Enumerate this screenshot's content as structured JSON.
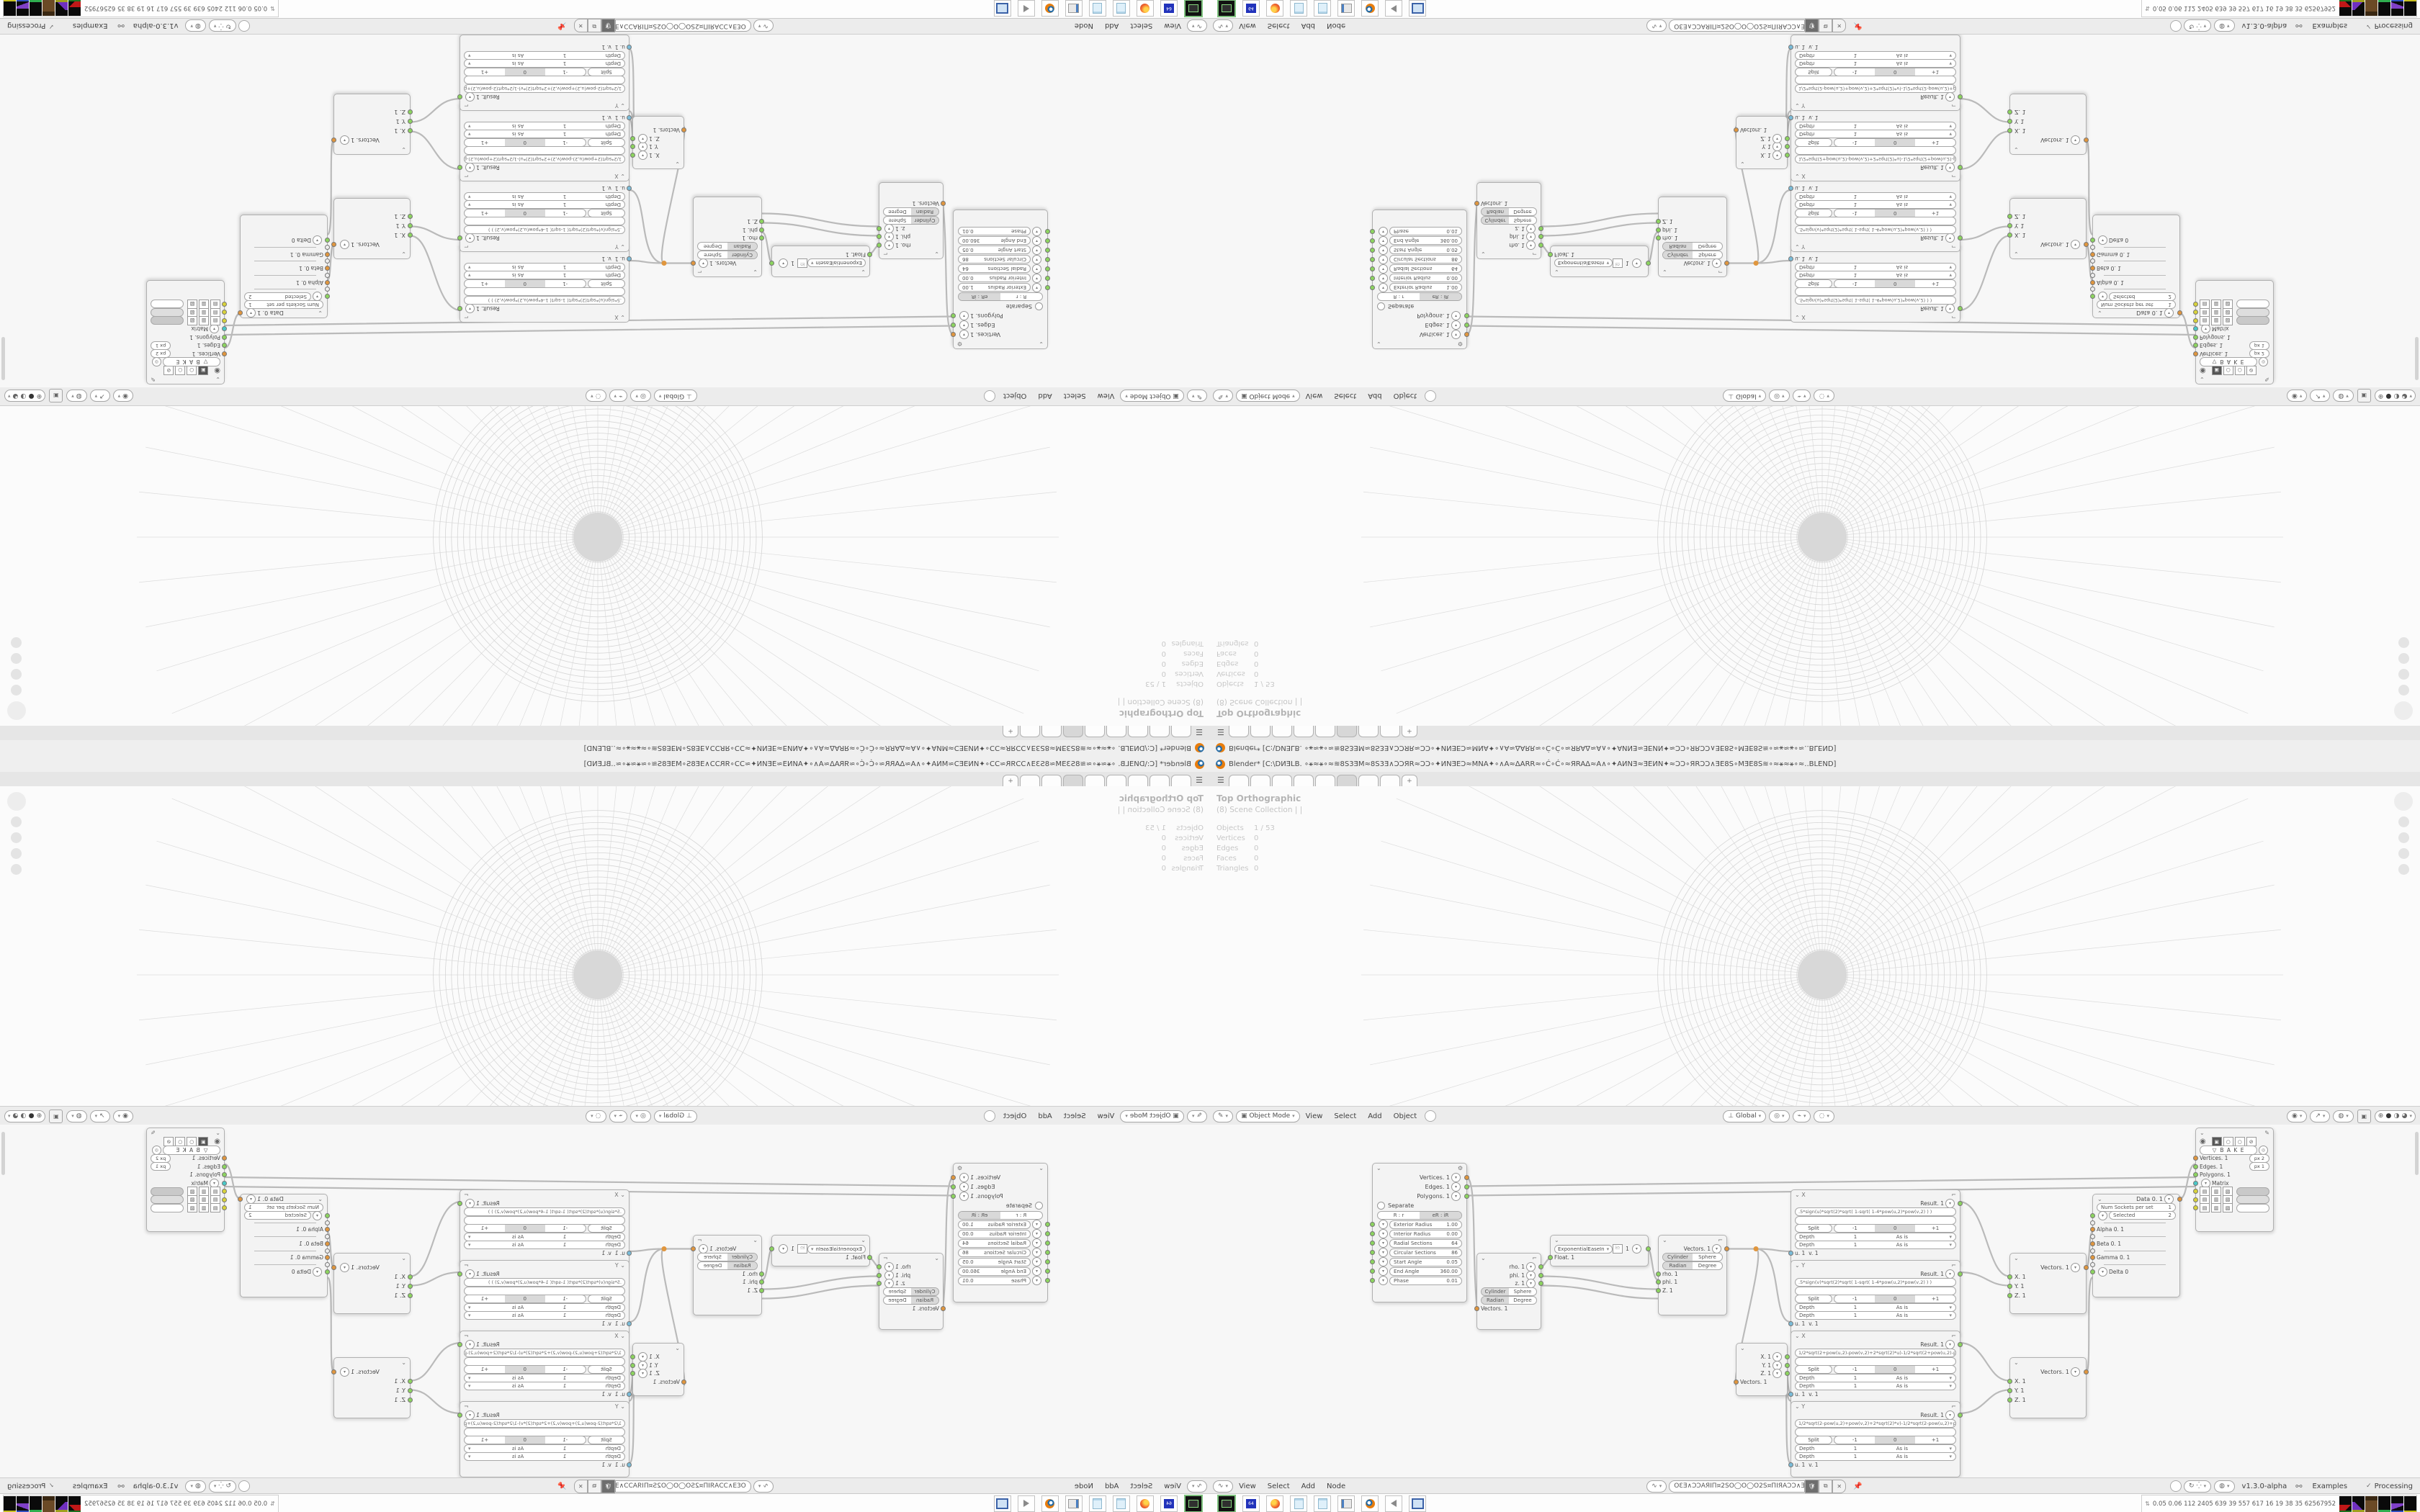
{
  "window": {
    "title": "Blender* [C:\\DИƎLB. ∘⚹≈⚹∘≈≋8S3ƎM≈8S3Ǝ∧ƆƆЯR≈ƆƆ∘✦ИNƎEƆ≈MNA✦∘∧A≈ΔARR≈∘Ć∘Ć∘≈ЯRAΔ≈A∧∘✦AИNƎ≈ƎEИN✦≈ƆƆ∘ЯRƆƆ∧ƎE8S∘MƎE8S≋∘≈⚹≈⚹∘≈..BLEND]",
    "tab_add": "+"
  },
  "viewport": {
    "view_label": "Top Orthographic",
    "collection_label": "(8) Scene Collection | |",
    "stats": [
      {
        "label": "Objects",
        "value": "1 / 53"
      },
      {
        "label": "Vertices",
        "value": "0"
      },
      {
        "label": "Edges",
        "value": "0"
      },
      {
        "label": "Faces",
        "value": "0"
      },
      {
        "label": "Triangles",
        "value": "0"
      }
    ],
    "header": {
      "mode": "Object Mode",
      "menu_view": "View",
      "menu_select": "Select",
      "menu_add": "Add",
      "menu_object": "Object",
      "orientation": "Global"
    }
  },
  "node_editor": {
    "header": {
      "menu_view": "View",
      "menu_select": "Select",
      "menu_add": "Add",
      "menu_node": "Node",
      "tree_name": "OƐƎ∧ƆƆAЯIΠ¤2SO◯O◯O2S¤ΠIЯAƆƆ∧ƎƐO",
      "version": "v1.3.0-alpha",
      "examples_label": "Examples",
      "processing_label": "Processing"
    }
  },
  "nodes": {
    "torus": {
      "out_vertices": "Vertices. 1",
      "out_edges": "Edges. 1",
      "out_polygons": "Polygons. 1",
      "separate_label": "Separate",
      "mode_a": "R : r",
      "mode_b": "eR : iR",
      "params": [
        {
          "label": "Exterior Radius",
          "value": "1.00"
        },
        {
          "label": "Interior Radius",
          "value": "0.00"
        },
        {
          "label": "Radial Sections",
          "value": "64"
        },
        {
          "label": "Circular Sections",
          "value": "86"
        },
        {
          "label": "Start Angle",
          "value": "0.05"
        },
        {
          "label": "End Angle",
          "value": "360.00"
        },
        {
          "label": "Phase",
          "value": "0.01"
        }
      ]
    },
    "vector_polar_out": {
      "out_rho": "rho. 1",
      "out_phi": "phi. 1",
      "out_z": "z. 1",
      "toggle_cylinder": "Cylinder",
      "toggle_sphere": "Sphere",
      "toggle_radian": "Radian",
      "toggle_degree": "Degree",
      "in_vectors": "Vectors. 1"
    },
    "easing": {
      "mode": "ExponentialEaseIn",
      "value": "1",
      "in_float": "Float. 1"
    },
    "vector_polar_in": {
      "out_vectors": "Vectors. 1",
      "toggle_cylinder": "Cylinder",
      "toggle_sphere": "Sphere",
      "toggle_radian": "Radian",
      "toggle_degree": "Degree",
      "in_rho": "rho. 1",
      "in_phi": "phi. 1",
      "in_z": "Z. 1"
    },
    "vector_out": {
      "out_x": "X. 1",
      "out_y": "Y. 1",
      "out_z": "Z. 1",
      "in_vectors": "Vectors. 1"
    },
    "formula_common": {
      "result": "Result. 1",
      "split": "Split",
      "minus": "-1",
      "zero": "0",
      "plus": "+1",
      "depth_label": "Depth",
      "depth_value": "1",
      "wrap": "As is",
      "in_u": "u. 1",
      "in_v": "v. 1"
    },
    "formulas": [
      {
        "label": "X",
        "formula": ".5*sign(u)*sqrt(2)*sqrt( 1-sqrt( 1-4*pow(u,2)*pow(v,2) ) )"
      },
      {
        "label": "Y",
        "formula": ".5*sign(v)*sqrt(2)*sqrt( 1-sqrt( 1-4*pow(u,2)*pow(v,2) ) )"
      },
      {
        "label": "X",
        "formula": "1/2*sqrt(2+pow(u,2)-pow(v,2)+2*sqrt(2)*u)-1/2*sqrt(2+pow(u,2)-pow(v,2)-2*sqrt(2)*u)"
      },
      {
        "label": "Y",
        "formula": "1/2*sqrt(2-pow(u,2)+pow(v,2)+2*sqrt(2)*v)-1/2*sqrt(2-pow(u,2)+pow(v,2)-2*sqrt(2)*v)"
      }
    ],
    "vector_in": {
      "out_vectors": "Vectors. 1",
      "in_x": "X. 1",
      "in_y": "Y. 1",
      "in_z": "Z. 1"
    },
    "input_switch": {
      "out_data": "Data 0. 1",
      "num_sockets_label": "Num Sockets per set",
      "num_sockets_value": "1",
      "selected_label": "Selected",
      "selected_value": "2",
      "in_alpha": "Alpha 0. 1",
      "in_beta": "Beta 0. 1",
      "in_gamma": "Gamma 0. 1",
      "in_delta": "Delta 0"
    },
    "viewer": {
      "bake_label": "B A K E",
      "in_vertices": "Vertices. 1",
      "vertices_badge": "px   2",
      "in_edges": "Edges. 1",
      "edges_badge": "px   1",
      "in_polygons": "Polygons. 1",
      "in_matrix": "Matrix"
    }
  },
  "taskbar": {
    "perf_numbers": "0.05 0.06 112 2405 639   39   557   617   16   19   38   35   62567952",
    "floppy_label": "64"
  },
  "colors": {
    "accent_orange": "#e0963e",
    "socket_green": "#8cd45f",
    "socket_cyan": "#49c8c8",
    "socket_yellow": "#d8d23a",
    "socket_blue": "#79bcd9",
    "grid_line": "#d5d5d5"
  }
}
